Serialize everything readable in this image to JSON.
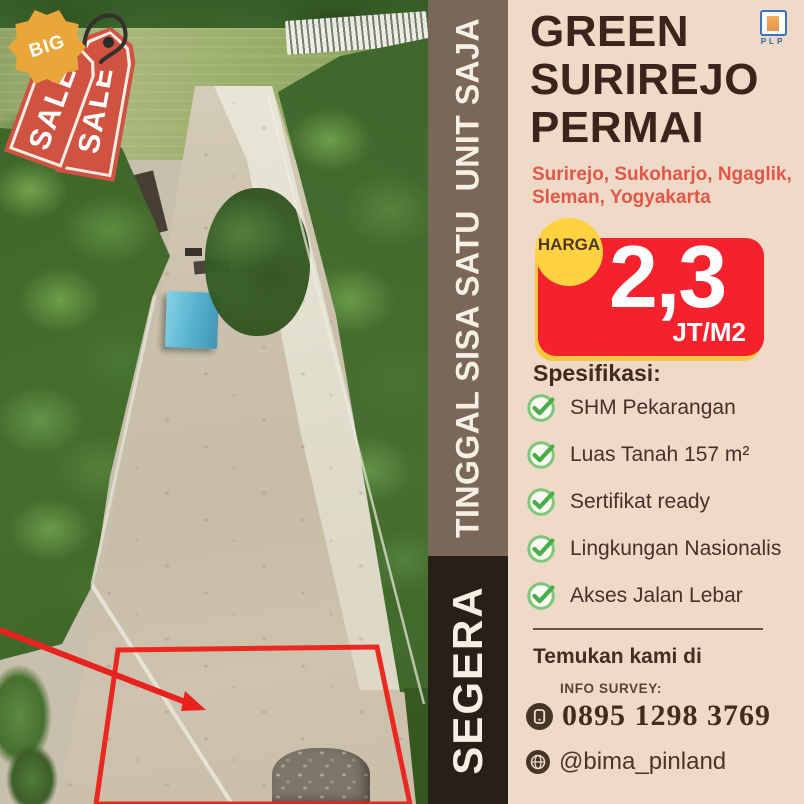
{
  "poster": {
    "tags": {
      "big_badge": "BIG",
      "sale_tag_front": "SALE",
      "sale_tag_back": "SALE"
    },
    "strip": {
      "vertical_text": "TINGGAL SISA SATU  UNIT SAJA",
      "bottom_vertical_text": "SEGERA"
    },
    "panel": {
      "logo_text": "PLP",
      "title_lines": [
        "GREEN",
        "SURIREJO",
        "PERMAI"
      ],
      "subtitle_lines": [
        "Surirejo, Sukoharjo, Ngaglik,",
        "Sleman, Yogyakarta"
      ],
      "price": {
        "label": "HARGA",
        "value": "2,3",
        "unit": "JT/M2"
      },
      "spec_heading": "Spesifikasi:",
      "specs": [
        "SHM Pekarangan",
        "Luas Tanah 157 m²",
        "Sertifikat ready",
        "Lingkungan Nasionalis",
        "Akses Jalan Lebar"
      ],
      "find_us": "Temukan kami di",
      "info_survey_label": "INFO SURVEY:",
      "phone": "0895 1298 3769",
      "social_handle": "@bima_pinland"
    },
    "colors": {
      "panel_bg": "#eedac7",
      "strip_brown": "#7b6757",
      "strip_black": "#262019",
      "title_brown": "#3a241b",
      "subtitle_red": "#e2574a",
      "price_red": "#f5222d",
      "harga_yellow": "#ffd23f",
      "price_shadow_yellow": "#f8c93f",
      "check_green": "#49ad49",
      "tag_red": "#cf5340",
      "big_badge_orange": "#e9a63a",
      "plot_outline_red": "#ec2018"
    }
  }
}
